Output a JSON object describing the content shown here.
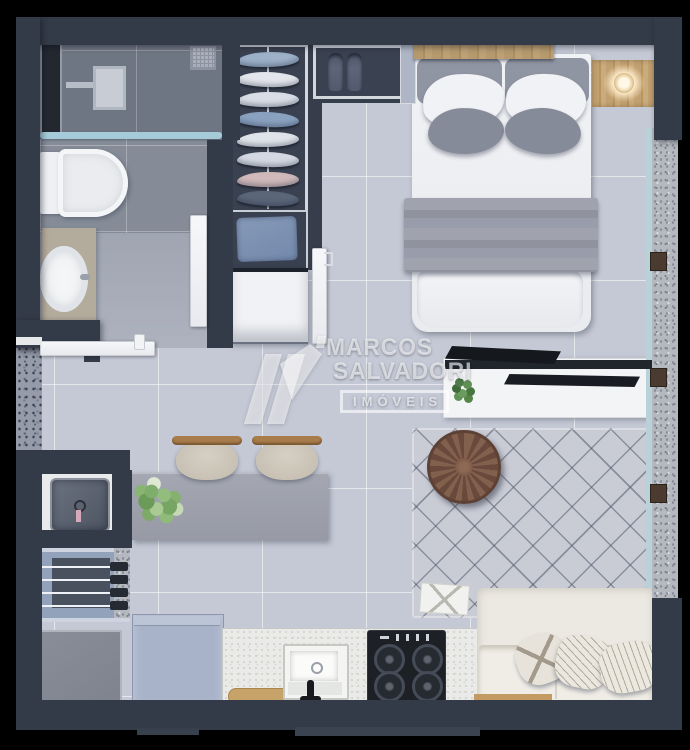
{
  "watermark": {
    "company_line1": "MARCOS",
    "company_line2": "SALVADORI",
    "company_line3": "IMÓVEIS",
    "logo": "marcos-salvadori-monogram"
  },
  "palette": {
    "background": "#000000",
    "wall": "#343b48",
    "floor_tile": "#c5c9d5",
    "shower_floor": "#6f7683",
    "glass_screen": "#a5cbd8",
    "wood_headboard": "#b69a6e",
    "wood_nightstand": "#c2a171",
    "lamp_glow": "#ffeccb",
    "bed_linen": "#eef0f4",
    "blanket_gray": "#989ba6",
    "rug": "#c9cbd5",
    "pouf_brown": "#7e5b4a",
    "sofa_cream": "#ece9e2",
    "counter_gray": "#9da0ab",
    "fridge_blue": "#a8b3c9",
    "countertop_terrazzo": "#eaeae8",
    "cooktop_black": "#1d2126",
    "window_glass": "#b9d2da",
    "laundry_basin": "#5a6170",
    "plant_green": "#7fae6a"
  },
  "wardrobe_clothes_colors": [
    "#9cb0c8",
    "#e3e6ec",
    "#d9dee6",
    "#8aa2c0",
    "#e0e4ea",
    "#d3d8e2",
    "#cfb9ba",
    "#5b6679"
  ],
  "furniture": [
    "shower",
    "floor-drain",
    "shower-glass-screen",
    "toilet",
    "bathroom-sink",
    "wall-niche",
    "bathroom-door",
    "wardrobe-hanging-clothes",
    "shoe-shelf",
    "folded-clothes-shelf",
    "dresser",
    "interior-door",
    "double-bed",
    "white-pillows",
    "gray-pillows",
    "headboard",
    "gray-throw-blanket",
    "nightstand",
    "table-lamp",
    "tv",
    "tv-bench",
    "floating-shelf",
    "decor-plant",
    "area-rug",
    "round-pouf",
    "sofa",
    "sofa-pillows",
    "breakfast-counter",
    "bar-stools",
    "counter-plant",
    "laundry-sink",
    "drying-rack",
    "washing-machine",
    "refrigerator",
    "kitchen-countertop",
    "kitchen-sink",
    "kitchen-faucet",
    "cooktop",
    "cutting-board",
    "dish-rack",
    "window",
    "curtain"
  ]
}
